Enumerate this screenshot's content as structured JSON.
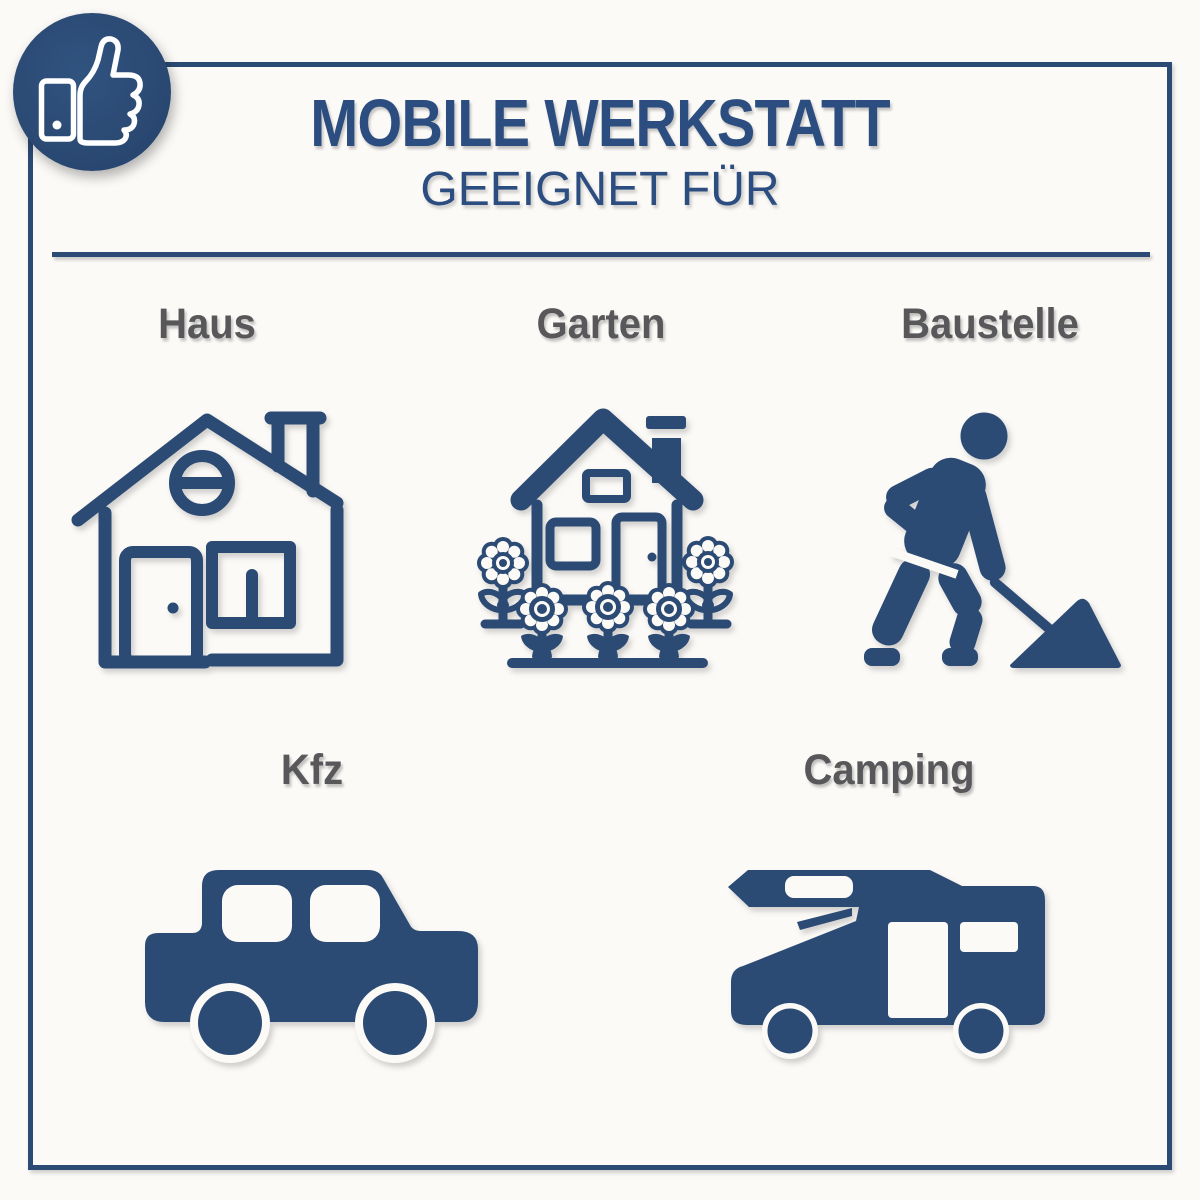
{
  "colors": {
    "navy": "#2b4a74",
    "title_blue": "#2c4d7f",
    "label_gray": "#58585a",
    "bg": "#fcfaf7",
    "white": "#ffffff"
  },
  "badge": {
    "icon": "thumbs-up-icon"
  },
  "header": {
    "title": "MOBILE WERKSTATT",
    "subtitle": "GEEIGNET FÜR"
  },
  "sections": {
    "row1": [
      {
        "label": "Haus",
        "icon": "house-icon"
      },
      {
        "label": "Garten",
        "icon": "garden-house-icon"
      },
      {
        "label": "Baustelle",
        "icon": "construction-worker-icon"
      }
    ],
    "row2": [
      {
        "label": "Kfz",
        "icon": "car-icon"
      },
      {
        "label": "Camping",
        "icon": "camper-van-icon"
      }
    ]
  }
}
